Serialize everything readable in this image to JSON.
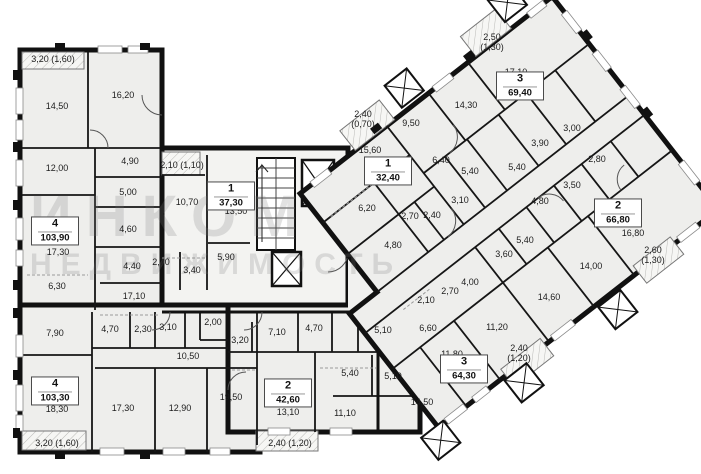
{
  "watermark": {
    "line1": "ИНКОМ",
    "line2": "НЕДВИЖИМОСТЬ"
  },
  "apartments": [
    {
      "rooms": "4",
      "area": "103,90",
      "x": 55,
      "y": 231
    },
    {
      "rooms": "1",
      "area": "37,30",
      "x": 231,
      "y": 196
    },
    {
      "rooms": "4",
      "area": "103,30",
      "x": 55,
      "y": 391
    },
    {
      "rooms": "2",
      "area": "42,60",
      "x": 288,
      "y": 393
    },
    {
      "rooms": "3",
      "area": "64,30",
      "x": 464,
      "y": 369
    },
    {
      "rooms": "1",
      "area": "32,40",
      "x": 388,
      "y": 171
    },
    {
      "rooms": "3",
      "area": "69,40",
      "x": 520,
      "y": 86
    },
    {
      "rooms": "2",
      "area": "66,80",
      "x": 618,
      "y": 213
    }
  ],
  "room_labels": [
    {
      "t": "3,20 (1,60)",
      "x": 53,
      "y": 59
    },
    {
      "t": "14,50",
      "x": 57,
      "y": 106
    },
    {
      "t": "16,20",
      "x": 123,
      "y": 95
    },
    {
      "t": "12,00",
      "x": 57,
      "y": 168
    },
    {
      "t": "4,90",
      "x": 130,
      "y": 161
    },
    {
      "t": "2,10 (1,10)",
      "x": 182,
      "y": 165
    },
    {
      "t": "5,00",
      "x": 128,
      "y": 192
    },
    {
      "t": "10,70",
      "x": 187,
      "y": 202
    },
    {
      "t": "17,30",
      "x": 58,
      "y": 252
    },
    {
      "t": "4,60",
      "x": 128,
      "y": 229
    },
    {
      "t": "2,70",
      "x": 161,
      "y": 262
    },
    {
      "t": "4,40",
      "x": 132,
      "y": 266
    },
    {
      "t": "3,40",
      "x": 192,
      "y": 270
    },
    {
      "t": "6,30",
      "x": 57,
      "y": 286
    },
    {
      "t": "17,10",
      "x": 134,
      "y": 296
    },
    {
      "t": "13,50",
      "x": 236,
      "y": 211
    },
    {
      "t": "5,90",
      "x": 226,
      "y": 257
    },
    {
      "t": "7,90",
      "x": 55,
      "y": 333
    },
    {
      "t": "4,70",
      "x": 110,
      "y": 329
    },
    {
      "t": "2,30",
      "x": 143,
      "y": 329
    },
    {
      "t": "3,10",
      "x": 168,
      "y": 327
    },
    {
      "t": "2,00",
      "x": 213,
      "y": 322
    },
    {
      "t": "10,50",
      "x": 188,
      "y": 356
    },
    {
      "t": "18,30",
      "x": 57,
      "y": 409
    },
    {
      "t": "17,30",
      "x": 123,
      "y": 408
    },
    {
      "t": "12,90",
      "x": 180,
      "y": 408
    },
    {
      "t": "19,50",
      "x": 231,
      "y": 397
    },
    {
      "t": "3,20 (1,60)",
      "x": 57,
      "y": 443
    },
    {
      "t": "3,20",
      "x": 240,
      "y": 340
    },
    {
      "t": "7,10",
      "x": 277,
      "y": 332
    },
    {
      "t": "4,70",
      "x": 314,
      "y": 328
    },
    {
      "t": "13,10",
      "x": 288,
      "y": 412
    },
    {
      "t": "11,10",
      "x": 345,
      "y": 413
    },
    {
      "t": "2,40 (1,20)",
      "x": 290,
      "y": 443
    },
    {
      "t": "5,10",
      "x": 383,
      "y": 330
    },
    {
      "t": "5,40",
      "x": 350,
      "y": 373
    },
    {
      "t": "5,10",
      "x": 393,
      "y": 376
    },
    {
      "t": "2,10",
      "x": 426,
      "y": 300
    },
    {
      "t": "2,70",
      "x": 450,
      "y": 291
    },
    {
      "t": "4,00",
      "x": 470,
      "y": 282
    },
    {
      "t": "6,60",
      "x": 428,
      "y": 328
    },
    {
      "t": "11,20",
      "x": 497,
      "y": 327
    },
    {
      "t": "11,80",
      "x": 452,
      "y": 354
    },
    {
      "t": "14,50",
      "x": 422,
      "y": 402
    },
    {
      "t": "2,40",
      "t2": "(1,20)",
      "x": 519,
      "y": 353
    },
    {
      "t": "2,40",
      "t2": "(0,70)",
      "x": 363,
      "y": 119
    },
    {
      "t": "15,60",
      "x": 370,
      "y": 150
    },
    {
      "t": "6,20",
      "x": 367,
      "y": 208
    },
    {
      "t": "2,70",
      "x": 410,
      "y": 216
    },
    {
      "t": "2,40",
      "x": 432,
      "y": 215
    },
    {
      "t": "4,80",
      "x": 393,
      "y": 245
    },
    {
      "t": "2,50",
      "t2": "(1,30)",
      "x": 492,
      "y": 42
    },
    {
      "t": "17,10",
      "x": 516,
      "y": 72
    },
    {
      "t": "9,50",
      "x": 411,
      "y": 123
    },
    {
      "t": "14,30",
      "x": 466,
      "y": 105
    },
    {
      "t": "6,40",
      "x": 441,
      "y": 160
    },
    {
      "t": "5,40",
      "x": 470,
      "y": 171
    },
    {
      "t": "3,10",
      "x": 460,
      "y": 200
    },
    {
      "t": "3,00",
      "x": 572,
      "y": 128
    },
    {
      "t": "3,90",
      "x": 540,
      "y": 143
    },
    {
      "t": "5,40",
      "x": 517,
      "y": 167
    },
    {
      "t": "2,80",
      "x": 597,
      "y": 159
    },
    {
      "t": "3,50",
      "x": 572,
      "y": 185
    },
    {
      "t": "4,80",
      "x": 540,
      "y": 201
    },
    {
      "t": "16,80",
      "x": 633,
      "y": 233
    },
    {
      "t": "2,60",
      "t2": "(1,30)",
      "x": 653,
      "y": 255
    },
    {
      "t": "14,00",
      "x": 591,
      "y": 266
    },
    {
      "t": "14,60",
      "x": 549,
      "y": 297
    },
    {
      "t": "5,40",
      "x": 525,
      "y": 240
    },
    {
      "t": "3,60",
      "x": 504,
      "y": 254
    }
  ]
}
